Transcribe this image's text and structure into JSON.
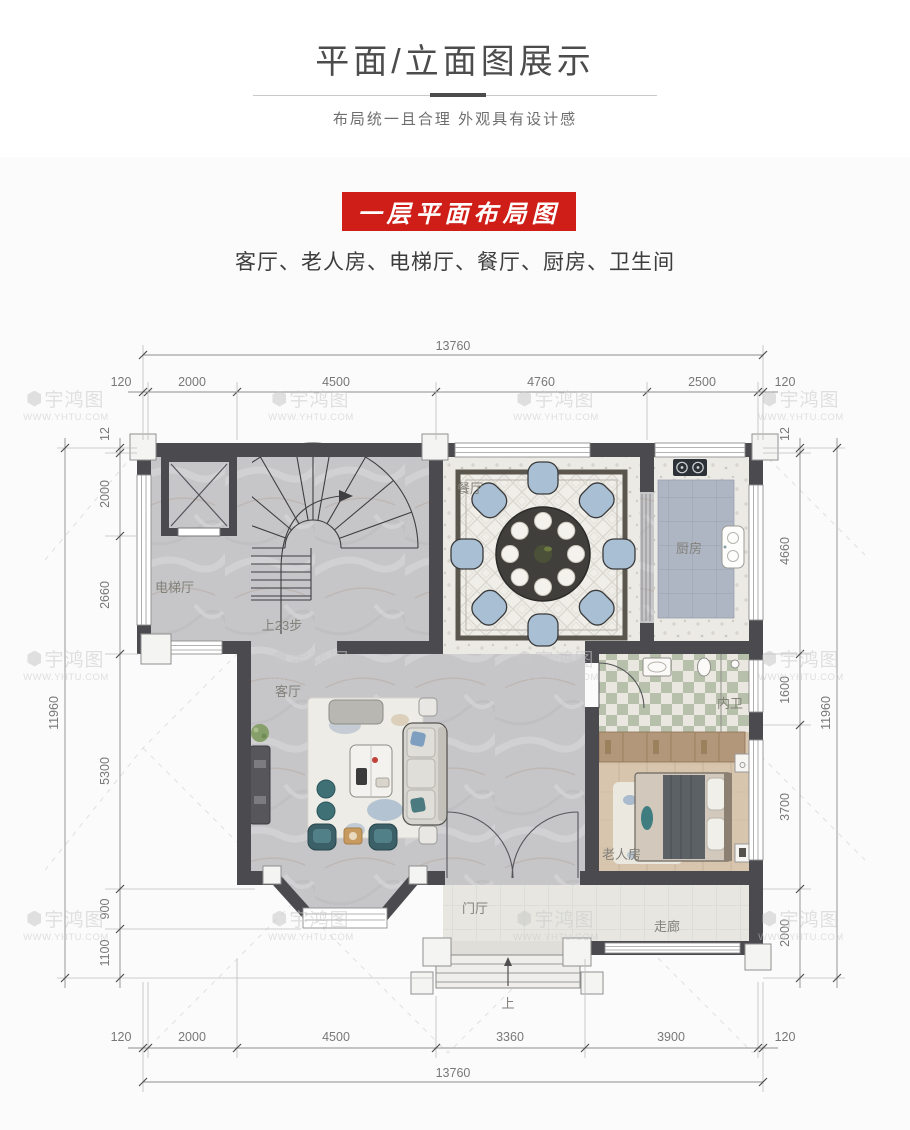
{
  "header": {
    "title": "平面/立面图展示",
    "subtitle": "布局统一且合理 外观具有设计感"
  },
  "section": {
    "banner_title": "一层平面布局图",
    "room_summary": "客厅、老人房、电梯厅、餐厅、厨房、卫生间"
  },
  "plan": {
    "room_labels": {
      "elevator_hall": "电梯厅",
      "living": "客厅",
      "dining": "餐厅",
      "kitchen": "厨房",
      "bath": "内卫",
      "elder_room": "老人房",
      "foyer": "门厅",
      "corridor": "走廊"
    },
    "stair_note": "上23步",
    "entry_step_note": "上",
    "dims": {
      "top_total": "13760",
      "top_segments": [
        "120",
        "2000",
        "4500",
        "4760",
        "2500",
        "120"
      ],
      "bottom_total": "13760",
      "bottom_segments": [
        "120",
        "2000",
        "4500",
        "3360",
        "3900",
        "120"
      ],
      "left_total": "11960",
      "left_segments": [
        "12",
        "2000",
        "2660",
        "5300",
        "900",
        "1100"
      ],
      "right_total": "11960",
      "right_segments": [
        "12",
        "4660",
        "1600",
        "3700",
        "2000"
      ]
    }
  },
  "watermark": {
    "name": "宇鸿图",
    "url": "WWW.YHTU.COM"
  },
  "colors": {
    "accent_red": "#cf1d17",
    "wall": "#4b4b4f",
    "dim_text": "#787878"
  }
}
